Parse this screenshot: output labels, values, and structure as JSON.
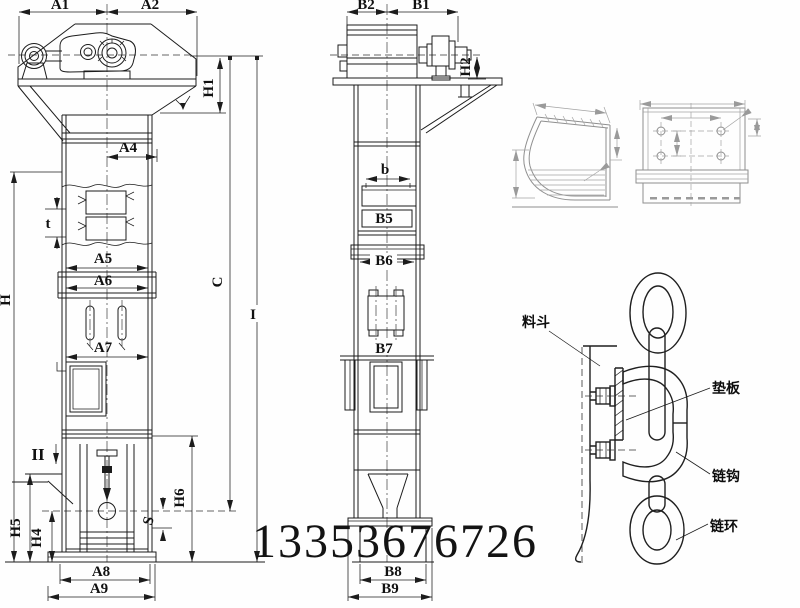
{
  "watermark": {
    "phone": "13353676726"
  },
  "front_view": {
    "dim_labels": {
      "a1": "A1",
      "a2": "A2",
      "h1": "H1",
      "a4": "A4",
      "t": "t",
      "a5": "A5",
      "a6": "A6",
      "a7": "A7",
      "a8": "A8",
      "a9": "A9",
      "h": "H",
      "h4": "H4",
      "h5": "H5",
      "h6": "H6",
      "s": "S",
      "c": "C",
      "i": "I",
      "ii": "II"
    }
  },
  "side_view": {
    "dim_labels": {
      "b1": "B1",
      "b2": "B2",
      "h2": "H2",
      "b": "b",
      "b5": "B5",
      "b6": "B6",
      "b7": "B7",
      "b8": "B8",
      "b9": "B9"
    }
  },
  "chain_detail": {
    "labels": {
      "bucket": "料斗",
      "backing_plate": "垫板",
      "chain_hook": "链钩",
      "chain_link": "链环"
    }
  }
}
